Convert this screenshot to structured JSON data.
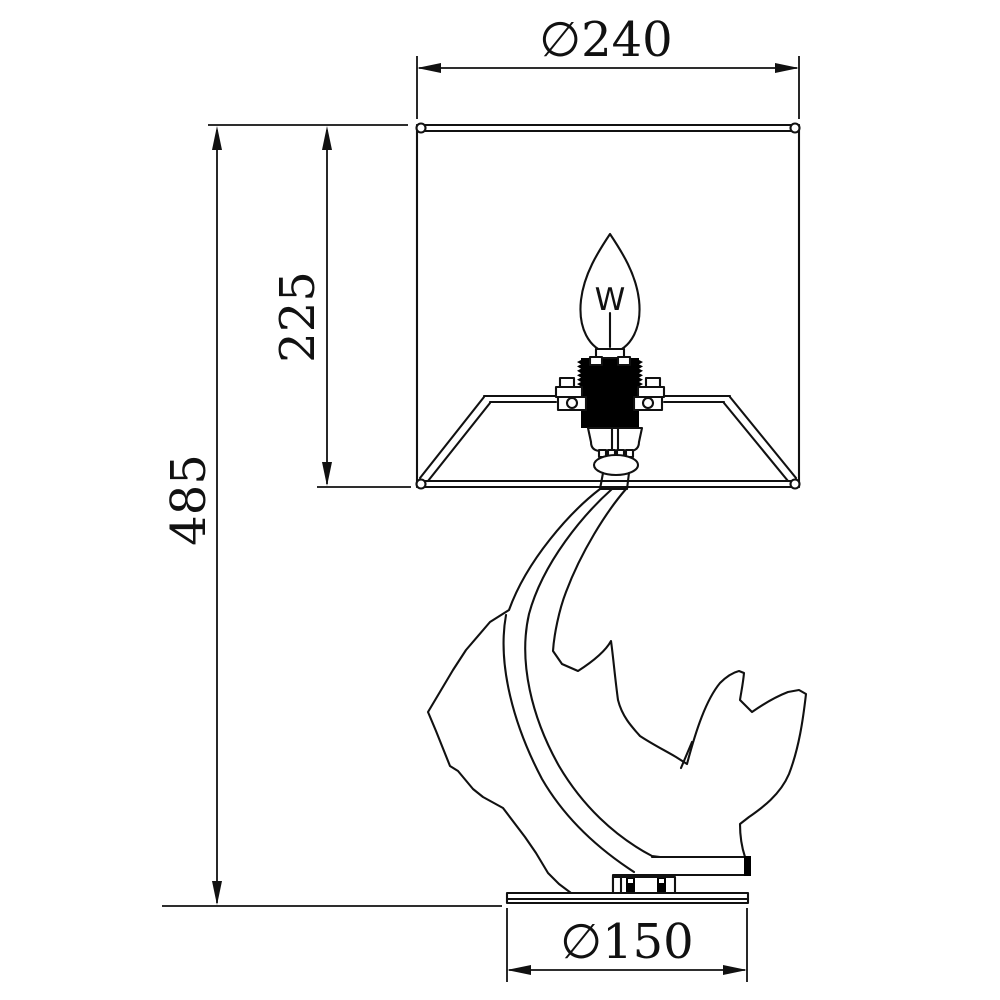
{
  "drawing": {
    "dim_shade_diameter": "∅240",
    "dim_shade_height": "225",
    "dim_total_height": "485",
    "dim_base_diameter": "∅150",
    "bulb_filament_marking": "W"
  },
  "colors": {
    "line": "#111111",
    "background": "#ffffff",
    "socket_fill": "#000000"
  }
}
